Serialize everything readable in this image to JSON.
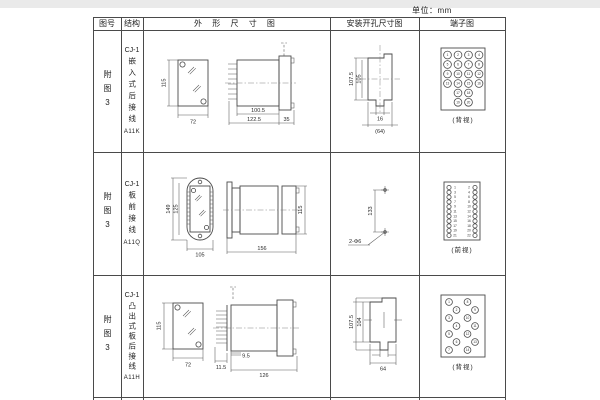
{
  "page": {
    "unit_label": "单位：mm"
  },
  "table": {
    "headers": {
      "fig_no": "图号",
      "structure": "结构",
      "outline": "外 形 尺 寸 图",
      "install": "安装开孔尺寸图",
      "terminal": "端子图"
    },
    "rows": [
      {
        "fig_no": "附图3",
        "model": "CJ-1",
        "mount": "嵌入式后接线",
        "code": "A11K",
        "outline": {
          "front_h": "115",
          "front_w": "72",
          "body_depth": "100.5",
          "total_depth": "122.5",
          "flange_depth": "35"
        },
        "install": {
          "v_outer": "107.5",
          "v_inner": "105",
          "h_inner": "16",
          "h_outer": "(64)"
        },
        "terminal": {
          "caption": "(背视)",
          "numbers": [
            "1",
            "2",
            "3",
            "4",
            "5",
            "6",
            "7",
            "8",
            "9",
            "10",
            "11",
            "12",
            "13",
            "14",
            "15",
            "16",
            "17",
            "18",
            "19",
            "20"
          ]
        }
      },
      {
        "fig_no": "附图3",
        "model": "CJ-1",
        "mount": "板前接线",
        "code": "A11Q",
        "outline": {
          "front_h_outer": "149",
          "front_h_inner": "125",
          "front_w": "105",
          "side_len": "156",
          "side_h": "115"
        },
        "install": {
          "v_span": "133",
          "hole_label": "2-Φ6"
        },
        "terminal": {
          "caption": "(前视)",
          "left_numbers": [
            "1",
            "3",
            "5",
            "7",
            "9",
            "11",
            "13",
            "15",
            "17",
            "19",
            "21"
          ],
          "right_numbers": [
            "2",
            "4",
            "6",
            "8",
            "10",
            "12",
            "14",
            "16",
            "18",
            "20",
            "22"
          ]
        }
      },
      {
        "fig_no": "附图3",
        "model": "CJ-1",
        "mount": "凸出式板后接线",
        "code": "A11H",
        "outline": {
          "front_h": "115",
          "front_w": "72",
          "pin_depth": "11.5",
          "offset": "9.5",
          "body_len": "126"
        },
        "install": {
          "v_outer": "107.5",
          "v_inner": "104",
          "h_outer": "64"
        },
        "terminal": {
          "caption": "(背视)",
          "numbers": [
            "1",
            "2",
            "3",
            "4",
            "5",
            "6",
            "7",
            "8",
            "9",
            "10",
            "11",
            "12",
            "13",
            "14"
          ]
        }
      }
    ]
  }
}
